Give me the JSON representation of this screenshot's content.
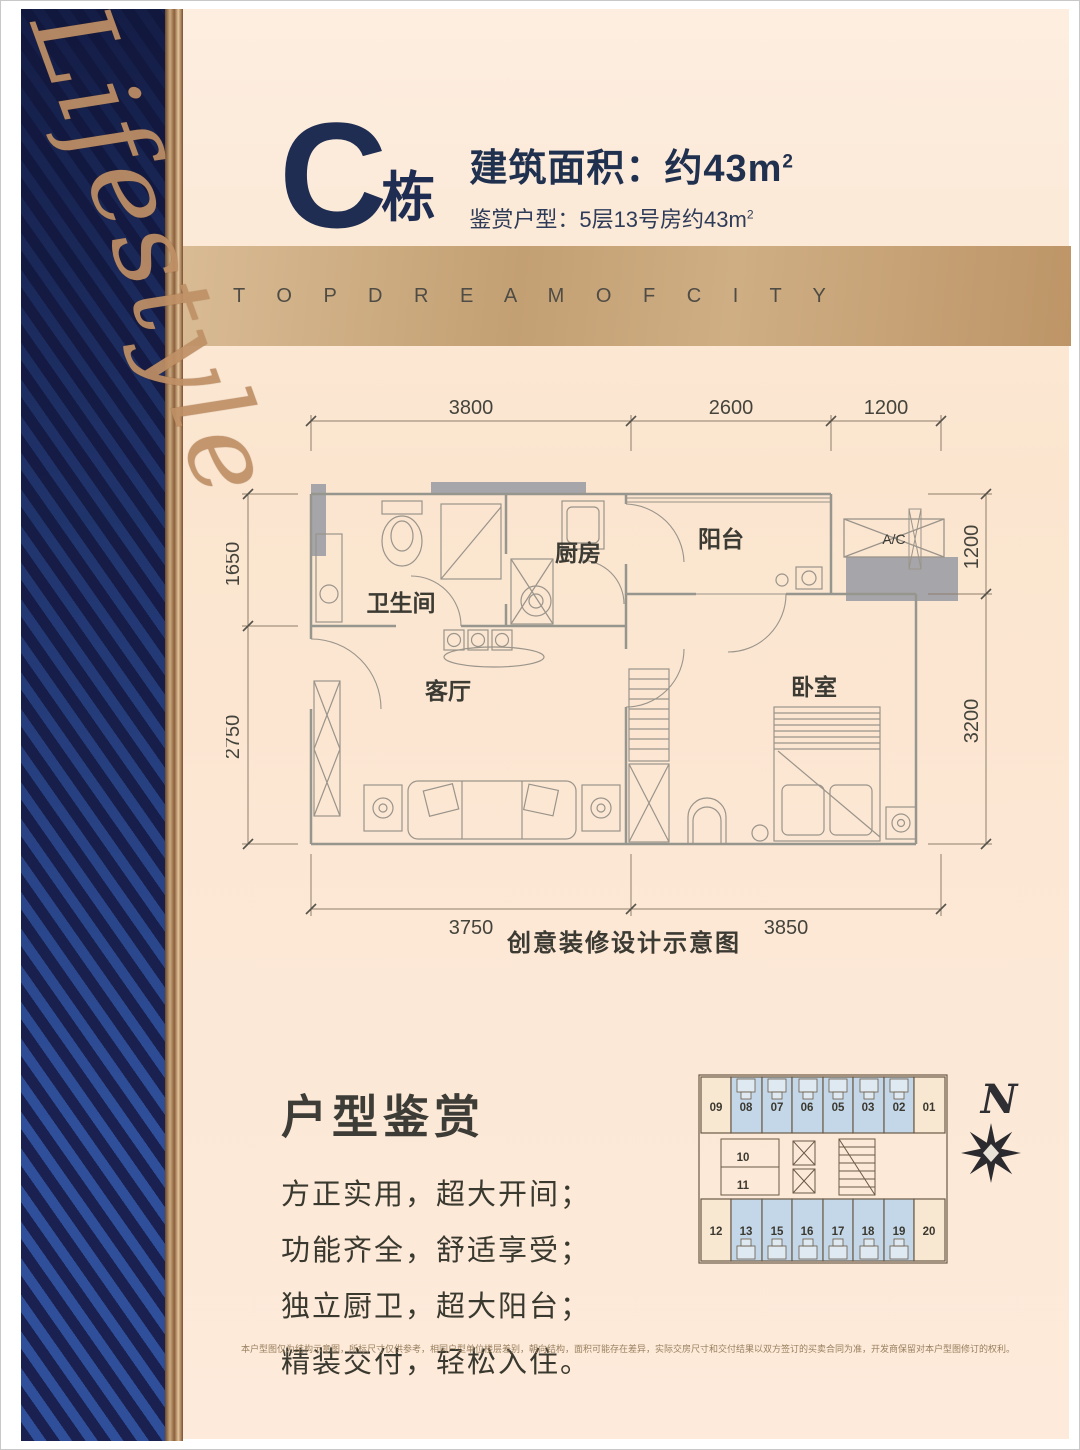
{
  "header": {
    "building": "C",
    "building_suffix": "栋",
    "area_label": "建筑面积：约43m",
    "area_sup": "2",
    "subtitle": "鉴赏户型：5层13号房约43m",
    "subtitle_sup": "2"
  },
  "side": {
    "script": "Lifestyle"
  },
  "banner": {
    "text": "T O P D R E A M O F C I T Y"
  },
  "floorplan": {
    "caption": "创意装修设计示意图",
    "labels": {
      "bathroom": "卫生间",
      "kitchen": "厨房",
      "balcony": "阳台",
      "living": "客厅",
      "bedroom": "卧室",
      "ac": "A/C"
    },
    "dims": {
      "top1": "3800",
      "top2": "2600",
      "top3": "1200",
      "left1": "1650",
      "left2": "2750",
      "right1": "1200",
      "right2": "3200",
      "bottom1": "3750",
      "bottom2": "3850"
    }
  },
  "appreciation": {
    "heading": "户型鉴赏",
    "lines": [
      "方正实用，超大开间；",
      "功能齐全，舒适享受；",
      "独立厨卫，超大阳台；",
      "精装交付，轻松入住。"
    ]
  },
  "keyplan": {
    "top_units": [
      "09",
      "08",
      "07",
      "06",
      "05",
      "03",
      "02",
      "01"
    ],
    "mid_units": [
      "10",
      "11"
    ],
    "bottom_units": [
      "12",
      "13",
      "15",
      "16",
      "17",
      "18",
      "19",
      "20"
    ],
    "compass": "N",
    "highlight_color": "#c3d7e8"
  },
  "disclaimer": "本户型图仅为结构示意图，所标尺寸仅供参考，相同户型单位楼层差别，朝向结构，面积可能存在差异，实际交房尺寸和交付结果以双方签订的买卖合同为准，开发商保留对本户型图修订的权利。",
  "colors": {
    "navy": "#202d52",
    "cream": "#fce8d6",
    "banner_tan": "#c3a073",
    "band_navy": "#1a2150",
    "gold": "#c09066"
  }
}
